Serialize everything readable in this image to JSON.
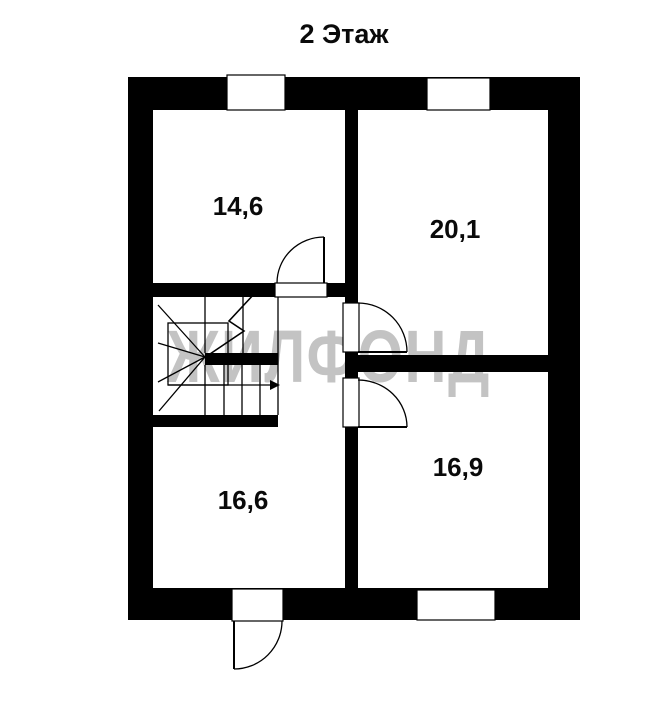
{
  "title": "2 Этаж",
  "watermark": "ЖИЛФОНД",
  "floor_plan": {
    "rooms": [
      {
        "id": "room-top-left",
        "area_label": "14,6"
      },
      {
        "id": "room-top-right",
        "area_label": "20,1"
      },
      {
        "id": "room-bottom-left",
        "area_label": "16,6"
      },
      {
        "id": "room-bottom-right",
        "area_label": "16,9"
      }
    ],
    "features": {
      "staircase": "winder-stair-with-up-arrow",
      "doors": [
        "room-top-left-door",
        "room-top-right-door",
        "room-bottom-right-door",
        "exterior-bottom-door"
      ],
      "windows": [
        "top-left-window",
        "top-right-window",
        "bottom-window"
      ]
    }
  },
  "colors": {
    "walls": "#000000",
    "background": "#ffffff",
    "watermark": "#c3c3c3",
    "labels": "#0a0a0a"
  }
}
